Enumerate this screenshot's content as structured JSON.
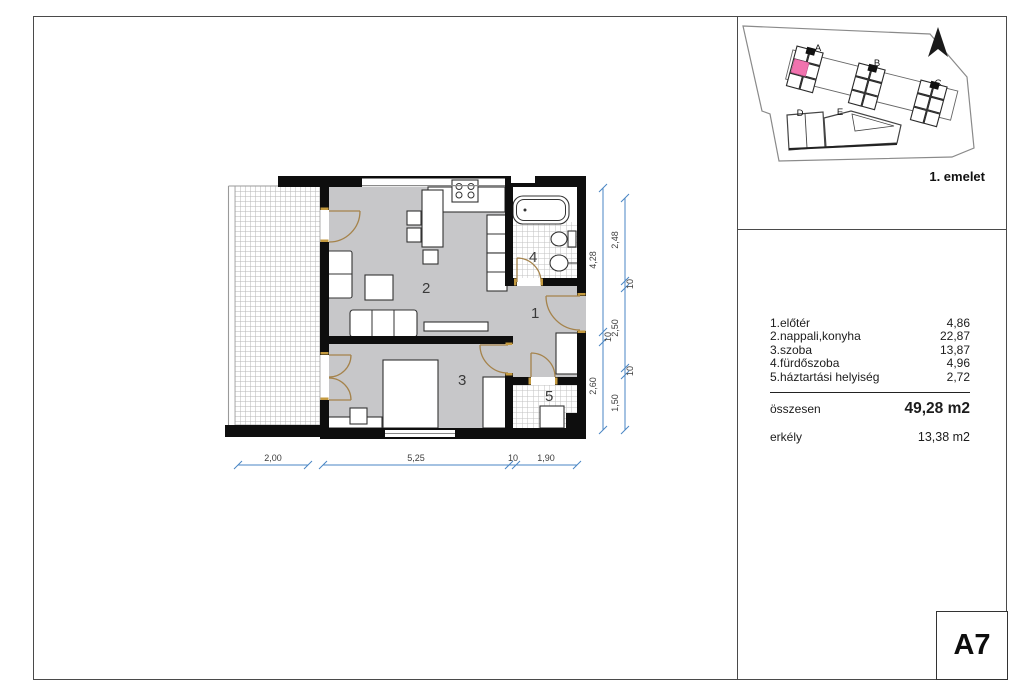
{
  "site_plan": {
    "floor_label": "1. emelet",
    "building_labels": {
      "a": "A",
      "b": "B",
      "c": "C",
      "d": "D",
      "e": "E"
    },
    "highlight_color": "#f173ae"
  },
  "floor_plan": {
    "room_numbers": {
      "hall": "1",
      "living": "2",
      "bedroom": "3",
      "bath": "4",
      "utility": "5"
    },
    "dims": {
      "bottom": [
        "2,00",
        "5,25",
        "10",
        "1,90"
      ],
      "right_inner": [
        "4,28",
        "10",
        "2,60"
      ],
      "right_outer": [
        "2,48",
        "10",
        "2,50",
        "10",
        "1,50"
      ]
    },
    "dim_color": "#4a86c4",
    "floor_color": "#c7c7c9"
  },
  "rooms_table": {
    "rows": [
      {
        "label": "1.előtér",
        "area": "4,86"
      },
      {
        "label": "2.nappali,konyha",
        "area": "22,87"
      },
      {
        "label": "3.szoba",
        "area": "13,87"
      },
      {
        "label": "4.fürdőszoba",
        "area": "4,96"
      },
      {
        "label": "5.háztartási helyiség",
        "area": "2,72"
      }
    ],
    "total_label": "összesen",
    "total_value": "49,28 m2",
    "balcony_label": "erkély",
    "balcony_value": "13,38 m2"
  },
  "unit_label": "A7"
}
